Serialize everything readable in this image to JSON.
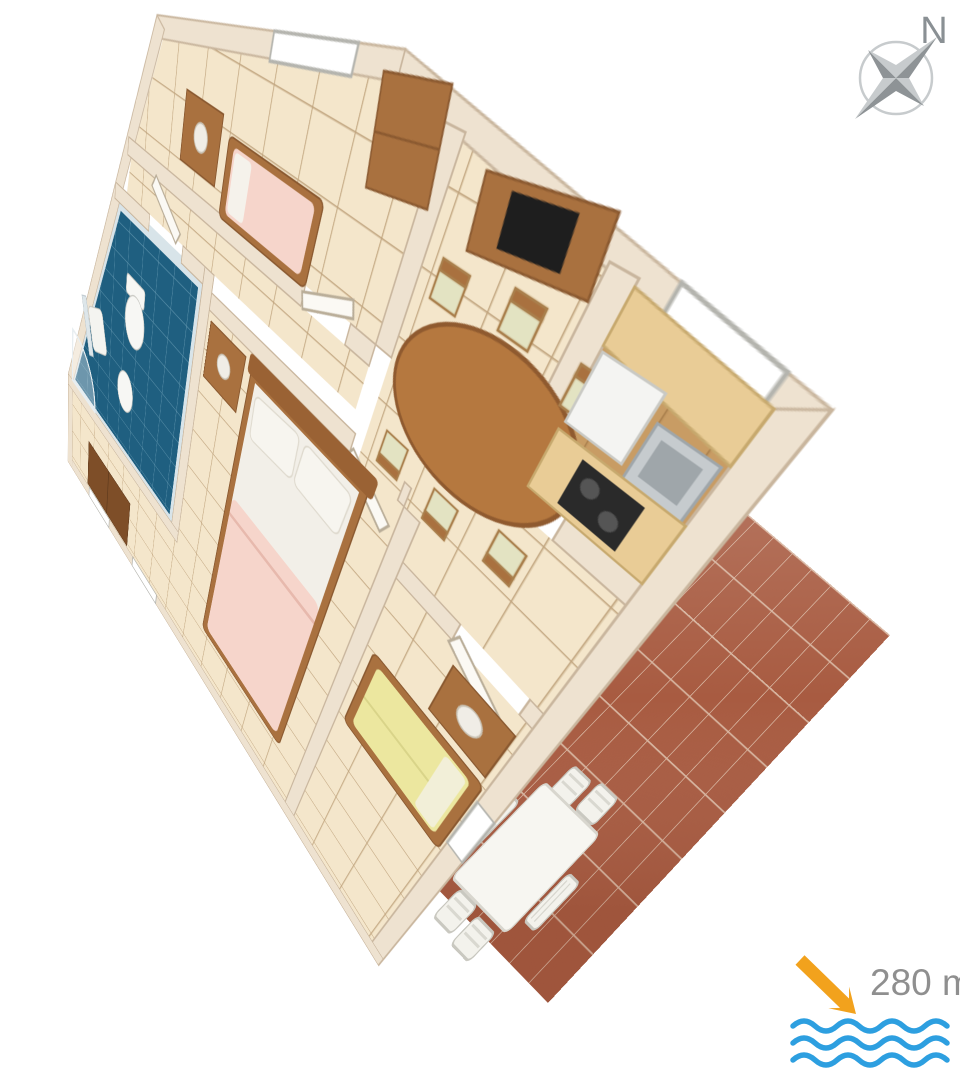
{
  "compass": {
    "label": "N"
  },
  "badge": {
    "distance": "280 m"
  },
  "colors": {
    "page_background": "#ffffff",
    "wall": "#eee2d0",
    "wall_edge": "#c9b69e",
    "floor_cream": "#f4e6cb",
    "floor_grout": "#c1a57f",
    "bathroom_floor": "#1f5f80",
    "bathroom_grout": "#5c92ab",
    "bathroom_wall_tile": "#d8e4e9",
    "kitchen_floor": "#c89c64",
    "terrace_tile": "#a85b41",
    "terrace_grout": "#d8b6a1",
    "furniture_wood": "#a9713f",
    "furniture_wood_dark": "#7e4e28",
    "maple_counter": "#e9cc96",
    "bed_pink": "#f6d5cb",
    "bed_white": "#f2efe8",
    "sofa_yellow": "#ece79f",
    "tv_black": "#1e1e1e",
    "white_furniture": "#f6f5f0",
    "arrow_orange": "#f2a21d",
    "wave_blue": "#2d9fe0",
    "distance_text": "#8f8f8f",
    "compass_gray_light": "#c7cbcd",
    "compass_gray_dark": "#8e9396"
  },
  "floor_plan": {
    "rooms": [
      {
        "name": "bedroom-small",
        "floor": "cream-tile",
        "furniture": [
          "nightstand-with-lamp",
          "window",
          "dresser",
          "single-bed-pink"
        ]
      },
      {
        "name": "bathroom",
        "floor": "blue-tile",
        "furniture": [
          "sink-with-mirror",
          "toilet",
          "bidet",
          "corner-shower",
          "door"
        ]
      },
      {
        "name": "hallway",
        "floor": "cream-tile",
        "furniture": []
      },
      {
        "name": "living-dining-room",
        "floor": "cream-tile",
        "furniture": [
          "tv-cabinet",
          "tv",
          "oval-dining-table",
          "six-chairs",
          "sliding-door-to-terrace"
        ]
      },
      {
        "name": "kitchen",
        "floor": "wood",
        "furniture": [
          "fridge",
          "sink",
          "cooktop",
          "counters",
          "window"
        ]
      },
      {
        "name": "bedroom-double",
        "floor": "cream-tile",
        "furniture": [
          "double-bed-pink",
          "wardrobe",
          "nightstand-with-lamp",
          "two-windows"
        ]
      },
      {
        "name": "single-room",
        "floor": "cream-tile",
        "furniture": [
          "single-bed-yellow",
          "nightstand-with-lamp",
          "window"
        ]
      },
      {
        "name": "terrace",
        "floor": "terracotta-tile",
        "furniture": [
          "white-table",
          "six-white-chairs",
          "open-louvered-door"
        ]
      }
    ]
  }
}
